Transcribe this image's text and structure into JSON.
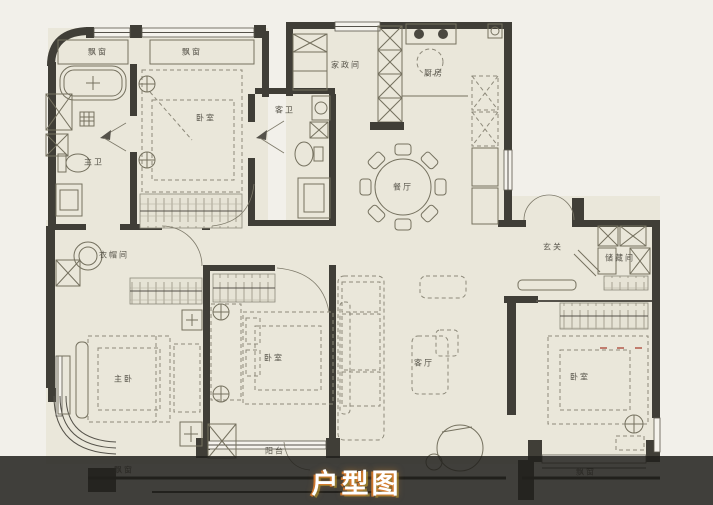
{
  "title": "户型图",
  "colors": {
    "background": "#f2f0ea",
    "floor": "#eae7da",
    "wall": "#403e37",
    "furniture_line": "#75715f",
    "overlay_band": "rgba(33,32,28,0.85)",
    "title_color": "#ffffff",
    "title_glow_orange": "#d97b2e",
    "title_glow_yellow": "#caa32c",
    "dimension_accent": "#b05040"
  },
  "rooms": {
    "bay_window_top_left": "飘窗",
    "bay_window_top": "飘窗",
    "master_bath": "主卫",
    "bedroom_top": "卧室",
    "guest_bath": "客卫",
    "laundry_room": "家政间",
    "kitchen": "厨房",
    "dining_room": "餐厅",
    "foyer": "玄关",
    "storage_room": "储藏间",
    "cloakroom": "衣帽间",
    "master_bedroom": "主卧",
    "bedroom_middle": "卧室",
    "living_room": "客厅",
    "bedroom_right": "卧室",
    "balcony": "阳台",
    "bay_window_bottom_left": "飘窗",
    "bay_window_bottom_right": "飘窗"
  }
}
